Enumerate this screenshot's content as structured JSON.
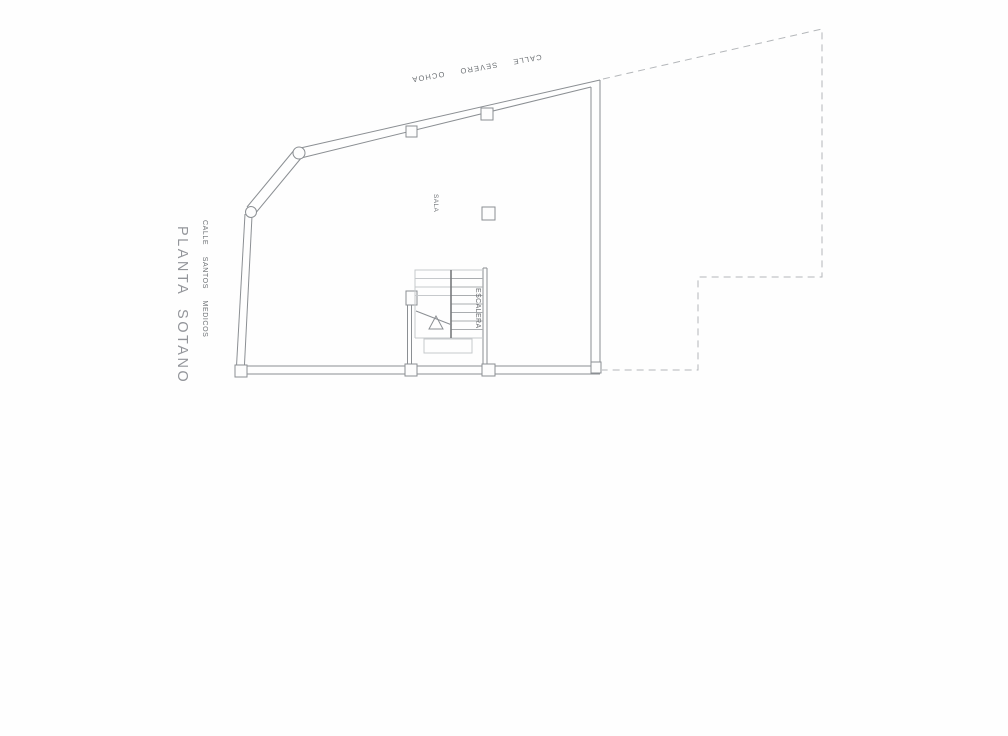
{
  "page": {
    "type": "scanned architectural floor plan",
    "title": "PLANTA SOTANO"
  },
  "labels": {
    "plan_title": "PLANTA SOTANO",
    "street_top": "CALLE SEVERO OCHOA",
    "street_left": "CALLE SANTOS MEDICOS",
    "room_sala": "SALA",
    "room_escalera": "ESCALERA"
  },
  "colors": {
    "background": "#fefefe",
    "wall_line": "#8b8f93",
    "inner_light_line": "#c6c9cc",
    "stair_divider": "#77797c",
    "tread_line": "#aaadb0",
    "dashed_boundary": "#b4b7ba",
    "column_fill": "#fdfdfd",
    "label_text": "#6b6f73",
    "title_text": "#93959a"
  }
}
